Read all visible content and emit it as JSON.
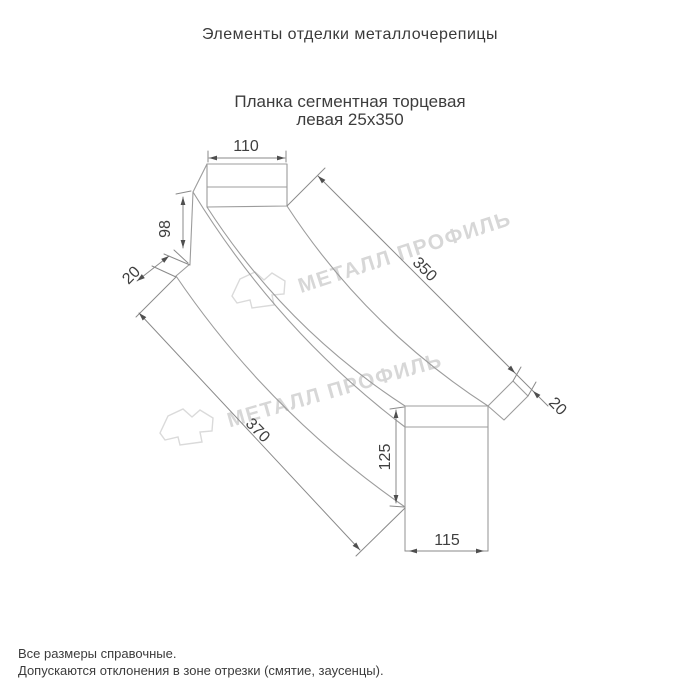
{
  "page": {
    "title": "Элементы отделки металлочерепицы"
  },
  "product": {
    "name_line1": "Планка сегментная торцевая",
    "name_line2": "левая 25х350"
  },
  "drawing": {
    "dimensions": {
      "flange_width_top": "110",
      "leg_height_left": "98",
      "hem_left": "20",
      "length_top": "350",
      "length_bottom": "370",
      "fold_right": "20",
      "face_height_right": "125",
      "face_width_right": "115"
    },
    "watermark_text": "МЕТАЛЛ ПРОФИЛЬ"
  },
  "footer": {
    "note1": "Все размеры справочные.",
    "note2": "Допускаются отклонения в зоне отрезки (смятие, заусенцы)."
  },
  "colors": {
    "heading_text": "#3a3a3a",
    "dimension_text": "#3f3f3f",
    "drawing_line": "#9c9c9c",
    "dimension_line": "#8a8a8a",
    "arrow": "#4f4f4f",
    "watermark": "#d7d7d7",
    "background": "#ffffff"
  }
}
